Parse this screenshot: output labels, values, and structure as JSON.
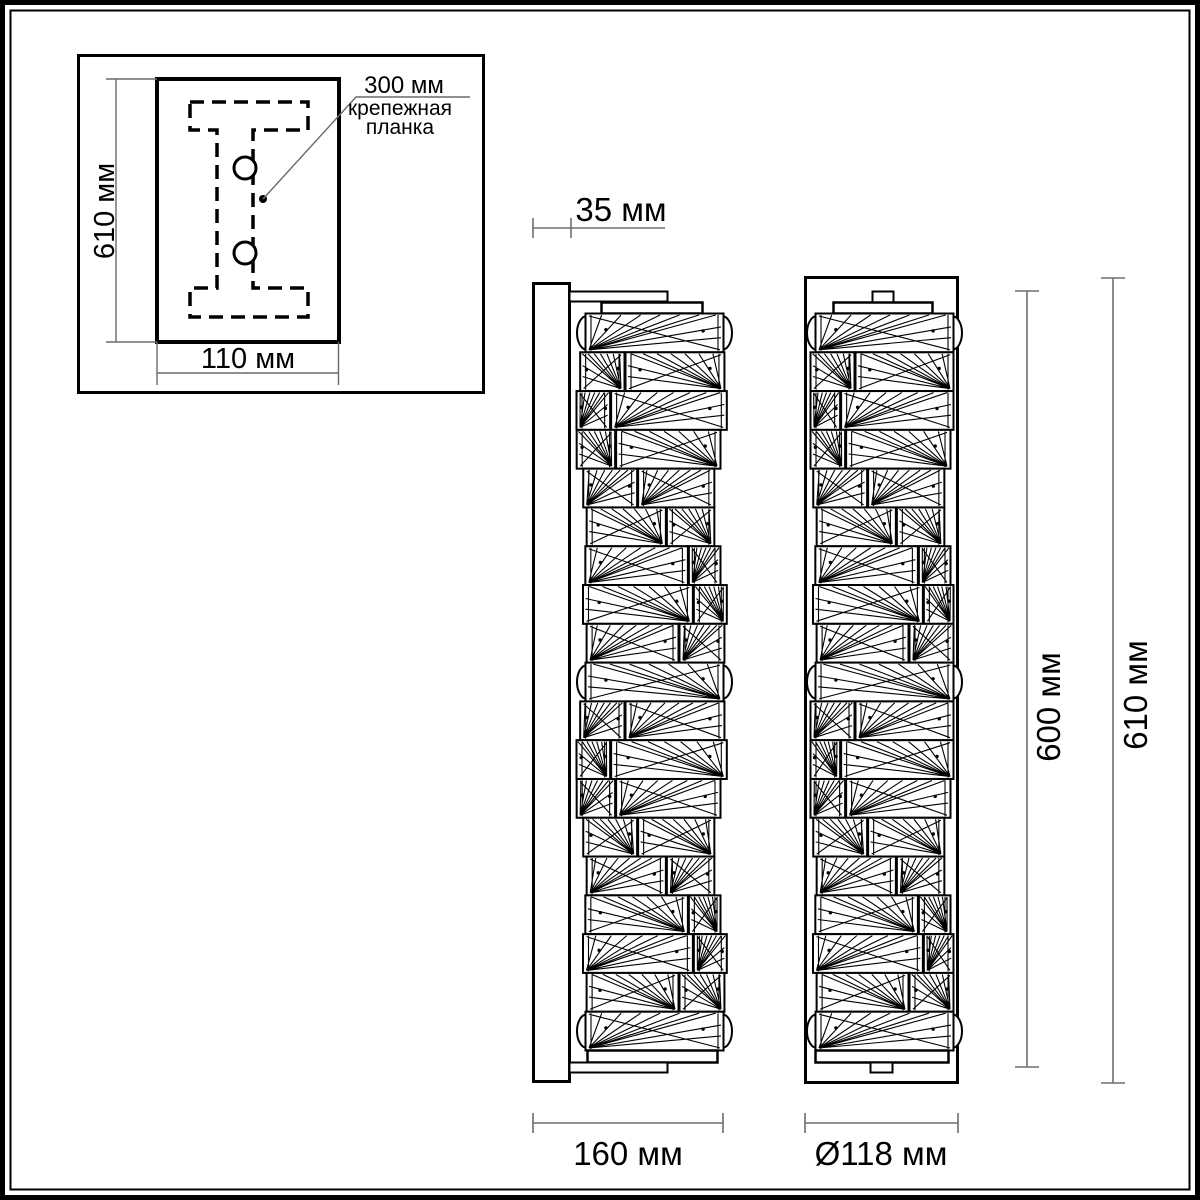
{
  "inset": {
    "height_label": "610 мм",
    "width_label": "110 мм",
    "callout_value": "300 мм",
    "callout_name_line1": "крепежная",
    "callout_name_line2": "планка"
  },
  "front_view": {
    "depth_label": "35 мм",
    "width_label": "160 мм"
  },
  "side_view": {
    "diameter_label": "Ø118 мм",
    "lamp_height_label": "600 мм",
    "total_height_label": "610 мм"
  },
  "colors": {
    "line": "#000000",
    "dimension_line": "#6e6e6e",
    "background": "#ffffff"
  }
}
